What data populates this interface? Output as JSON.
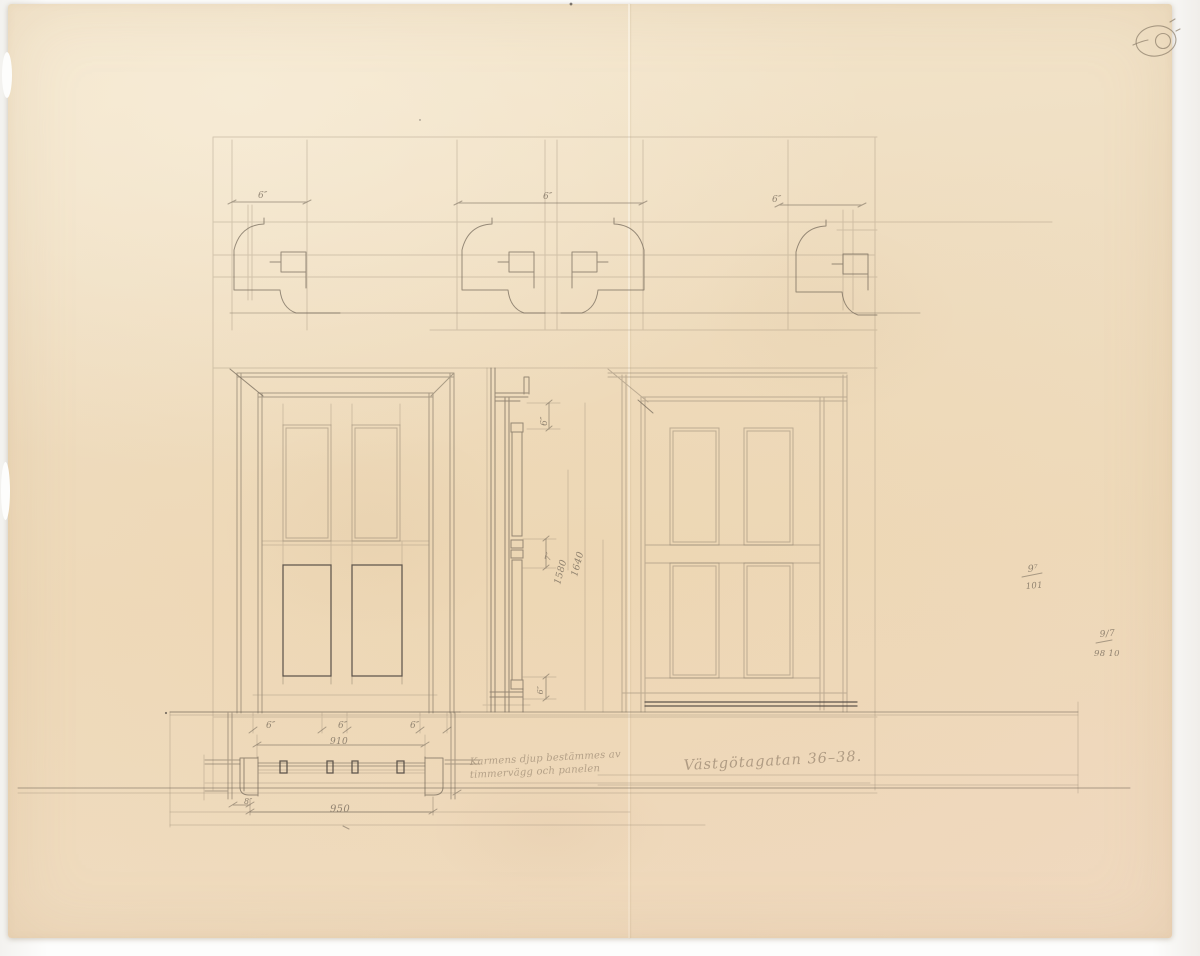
{
  "annotations": {
    "street_label": "Västgötagatan 36–38.",
    "note_line1": "Karmens djup bestämmes av",
    "note_line2": "timmervägg och panelen",
    "ref_upper_value": "9⁷",
    "ref_upper_number": "101",
    "ref_lower_value": "9/7",
    "ref_lower_number": "98  10"
  },
  "dimensions": {
    "profile_left": "6″",
    "profile_middle": "6″",
    "profile_right": "6″",
    "under_door_1": "6″",
    "under_door_2": "6″",
    "under_door_3": "6″",
    "plan_inner_width": "910",
    "plan_outer_width": "950",
    "plan_offset": "8″",
    "section_top": "6″",
    "section_small": "7″",
    "height_inner": "1580",
    "height_outer": "1640",
    "section_bottom": "6″"
  },
  "colors": {
    "paper": "#efdcc0",
    "pencil": "#6f6456",
    "ink": "#46403a",
    "scan_background": "#fbfaf8"
  },
  "icons": {
    "stamp_mark": "circled-oval-stamp"
  }
}
